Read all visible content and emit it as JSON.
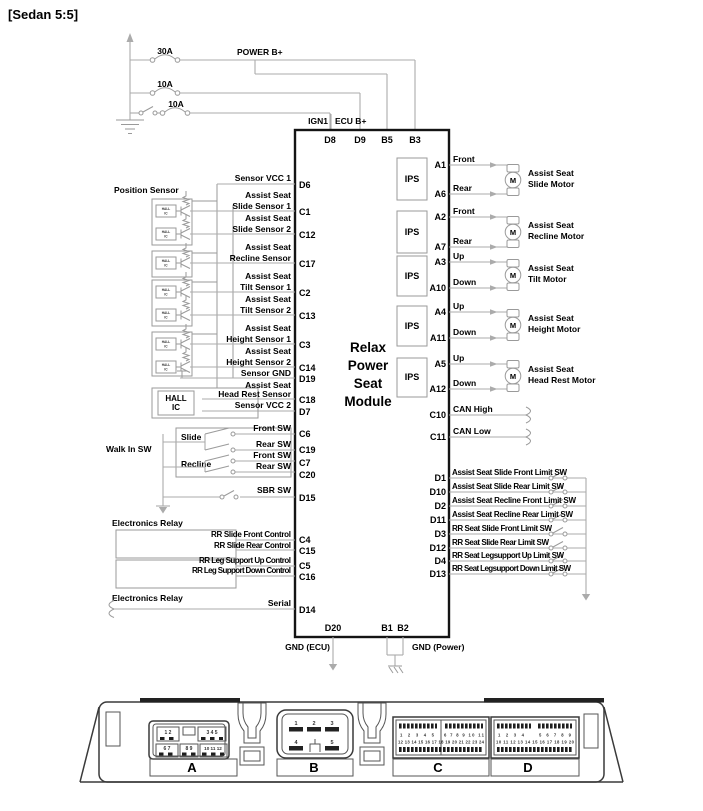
{
  "title": "[Sedan 5:5]",
  "power": {
    "fuses": [
      "30A",
      "10A",
      "10A"
    ],
    "power_b_label": "POWER B+",
    "ign1_label": "IGN1",
    "ecu_b_label": "ECU B+",
    "top_pins": [
      "D8",
      "D9",
      "B5",
      "B3"
    ]
  },
  "module": {
    "name_lines": [
      "Relax",
      "Power",
      "Seat",
      "Module"
    ],
    "bottom": {
      "d20": "D20",
      "b1": "B1",
      "b2": "B2",
      "gnd_ecu": "GND (ECU)",
      "gnd_power": "GND (Power)"
    }
  },
  "left": {
    "position_sensor_label": "Position Sensor",
    "hall_unit_l1": "HALL",
    "hall_unit_l2": "IC",
    "hall_big_l1": "HALL",
    "hall_big_l2": "IC",
    "sensor_rows": [
      {
        "l1": "",
        "l2": "Sensor VCC 1",
        "pin": "D6"
      },
      {
        "l1": "Assist Seat",
        "l2": "Slide Sensor 1",
        "pin": "C1"
      },
      {
        "l1": "Assist Seat",
        "l2": "Slide Sensor 2",
        "pin": "C12"
      },
      {
        "l1": "Assist Seat",
        "l2": "Recline Sensor",
        "pin": "C17"
      },
      {
        "l1": "Assist Seat",
        "l2": "Tilt Sensor 1",
        "pin": "C2"
      },
      {
        "l1": "Assist Seat",
        "l2": "Tilt Sensor 2",
        "pin": "C13"
      },
      {
        "l1": "Assist Seat",
        "l2": "Height Sensor 1",
        "pin": "C3"
      },
      {
        "l1": "Assist Seat",
        "l2": "Height Sensor 2",
        "pin": "C14"
      },
      {
        "l1": "",
        "l2": "Sensor GND",
        "pin": "D19"
      },
      {
        "l1": "Assist Seat",
        "l2": "Head Rest Sensor",
        "pin": "C18"
      },
      {
        "l1": "",
        "l2": "Sensor VCC 2",
        "pin": "D7"
      }
    ],
    "walk_in_sw_label": "Walk In SW",
    "slide_label": "Slide",
    "recline_label": "Recline",
    "switch_rows": [
      {
        "label": "Front SW",
        "pin": "C6"
      },
      {
        "label": "Rear SW",
        "pin": "C19"
      },
      {
        "label": "Front SW",
        "pin": "C7"
      },
      {
        "label": "Rear SW",
        "pin": "C20"
      }
    ],
    "sbr": {
      "label": "SBR SW",
      "pin": "D15"
    },
    "relay_label_top": "Electronics Relay",
    "relay_label_bottom": "Electronics Relay",
    "control_rows": [
      {
        "label": "RR Slide Front Control",
        "pin": "C4"
      },
      {
        "label": "RR Slide Rear Control",
        "pin": "C15"
      },
      {
        "label": "RR Leg Support Up Control",
        "pin": "C5"
      },
      {
        "label": "RR Leg Support Down Control",
        "pin": "C16"
      }
    ],
    "serial": {
      "label": "Serial",
      "pin": "D14"
    }
  },
  "right": {
    "ips_label": "IPS",
    "motor_m": "M",
    "motor_groups": [
      {
        "pin_top": "A1",
        "pin_bottom": "A6",
        "dir_top": "Front",
        "dir_bottom": "Rear",
        "l1": "Assist Seat",
        "l2": "Slide Motor"
      },
      {
        "pin_top": "A2",
        "pin_bottom": "A7",
        "dir_top": "Front",
        "dir_bottom": "Rear",
        "l1": "Assist Seat",
        "l2": "Recline Motor"
      },
      {
        "pin_top": "A3",
        "pin_bottom": "A10",
        "dir_top": "Up",
        "dir_bottom": "Down",
        "l1": "Assist Seat",
        "l2": "Tilt Motor"
      },
      {
        "pin_top": "A4",
        "pin_bottom": "A11",
        "dir_top": "Up",
        "dir_bottom": "Down",
        "l1": "Assist Seat",
        "l2": "Height Motor"
      },
      {
        "pin_top": "A5",
        "pin_bottom": "A12",
        "dir_top": "Up",
        "dir_bottom": "Down",
        "l1": "Assist Seat",
        "l2": "Head Rest Motor"
      }
    ],
    "can_rows": [
      {
        "pin": "C10",
        "label": "CAN High"
      },
      {
        "pin": "C11",
        "label": "CAN Low"
      }
    ],
    "limit_rows": [
      {
        "pin": "D1",
        "label": "Assist Seat Slide Front Limit SW"
      },
      {
        "pin": "D10",
        "label": "Assist Seat Slide Rear Limit SW"
      },
      {
        "pin": "D2",
        "label": "Assist Seat Recline Front Limit SW"
      },
      {
        "pin": "D11",
        "label": "Assist Seat Recline Rear Limit SW"
      },
      {
        "pin": "D3",
        "label": "RR Seat Slide Front Limit SW"
      },
      {
        "pin": "D12",
        "label": "RR Seat Slide Rear Limit SW"
      },
      {
        "pin": "D4",
        "label": "RR Seat Legsupport Up Limit SW"
      },
      {
        "pin": "D13",
        "label": "RR Seat Legsupport Down Limit SW"
      }
    ]
  },
  "connectors": {
    "labels": [
      "A",
      "B",
      "C",
      "D"
    ],
    "a_top": [
      "1 2",
      "3 4 5"
    ],
    "a_bottom": [
      "6 7",
      "8 9",
      "10 11 12"
    ],
    "b_row1": [
      "1",
      "2",
      "3"
    ],
    "b_row2": [
      "4",
      "5"
    ],
    "c_row1": [
      "1 2 3 4 5",
      "6 7 8 9 10 11"
    ],
    "c_row2": "12 13 14 15 16 17 18 19 20 21 22 23 24",
    "d_row1": [
      "1 2 3 4",
      "5 6 7 8 9"
    ],
    "d_row2": "10 11 12 13 14 15 16 17 18 19 20"
  },
  "colors": {
    "wire": "#ababab",
    "outline": "#141414",
    "text": "#000000"
  }
}
